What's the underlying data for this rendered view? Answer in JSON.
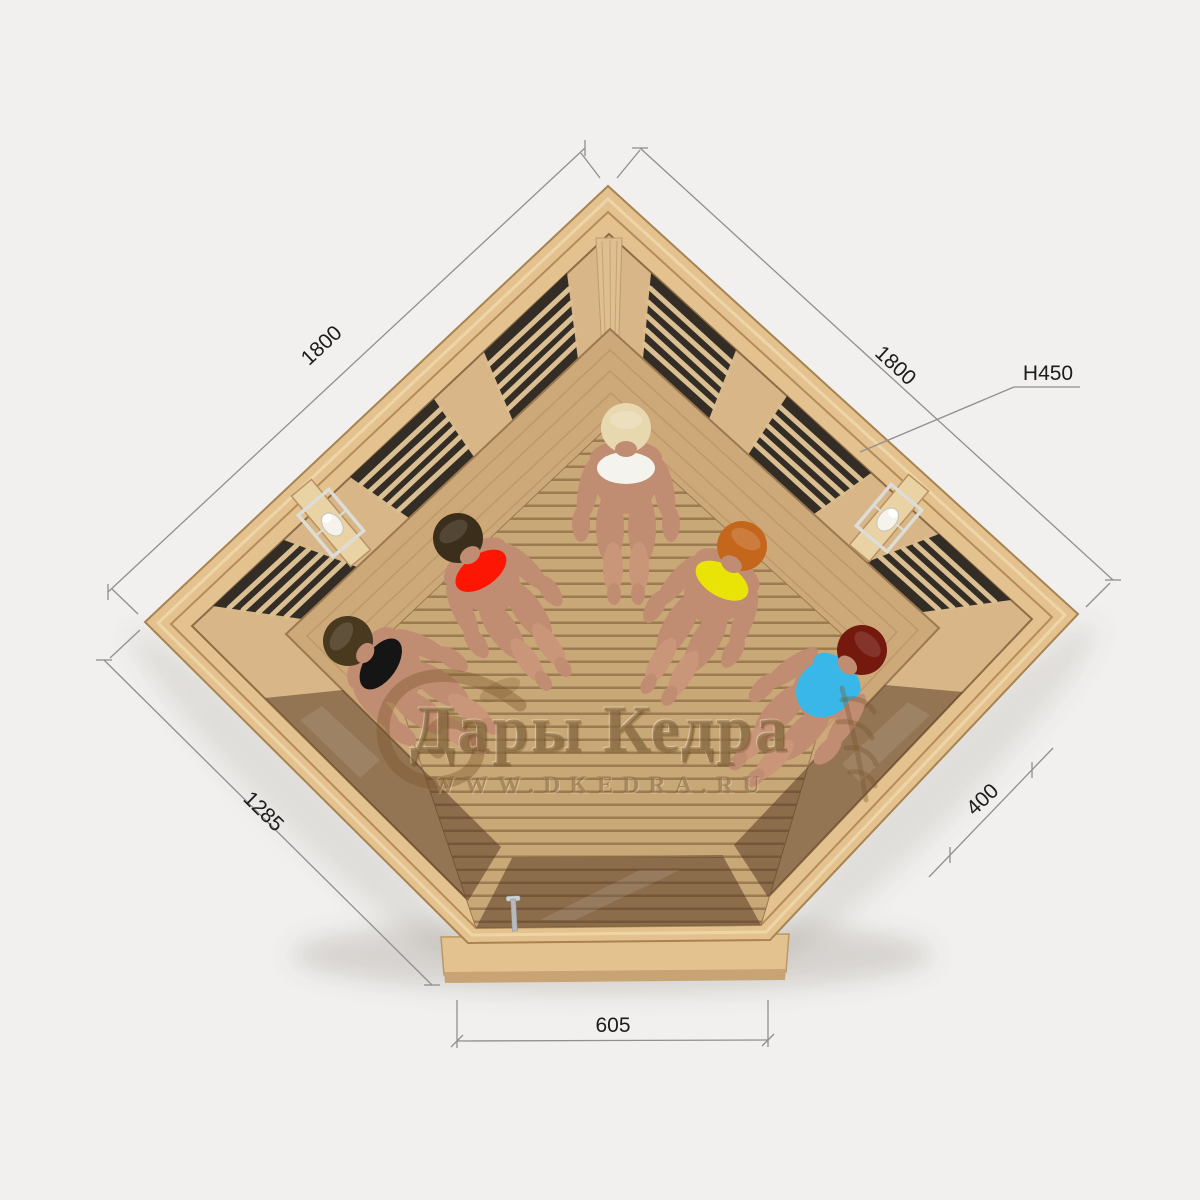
{
  "scene": {
    "title": "Corner infrared sauna — top view render",
    "background_color": "#f1f0ee"
  },
  "dimensions": {
    "left_wall": "1800",
    "right_wall": "1800",
    "height_mark": "H450",
    "front_left": "1285",
    "front_right": "400",
    "door_front": "605"
  },
  "watermark": {
    "title": "Дары Кедра",
    "url": "WWW.DKEDRA.RU"
  },
  "colors": {
    "frame_wood": "#e4c28f",
    "frame_edge": "#a9834f",
    "wall_wood": "#d8b687",
    "bench_wood": "#cda97a",
    "floor_wood": "#c9a878",
    "floor_gap": "#9c7b52",
    "panel_dark": "#342d25",
    "panel_strip": "#dabf92",
    "glass_tint": "rgba(77,49,31,0.5)",
    "dim_line": "#8f8f8f",
    "dim_text": "#1c1c1c",
    "watermark_tint": "rgba(122,88,44,0.55)",
    "skin": "#c18d72",
    "lamp_metal": "#dddcd6"
  },
  "people": [
    {
      "position": "far-left",
      "hair": "#49391f",
      "swimsuit": "#151515"
    },
    {
      "position": "mid-left",
      "hair": "#3b2e1a",
      "swimsuit": "#fe1604"
    },
    {
      "position": "center",
      "hair": "#e8d8af",
      "swimsuit": "#f5f3ee"
    },
    {
      "position": "mid-right",
      "hair": "#c4671c",
      "swimsuit": "#e9e406"
    },
    {
      "position": "far-right",
      "hair": "#75190e",
      "swimsuit": "#3ab7e9"
    }
  ]
}
